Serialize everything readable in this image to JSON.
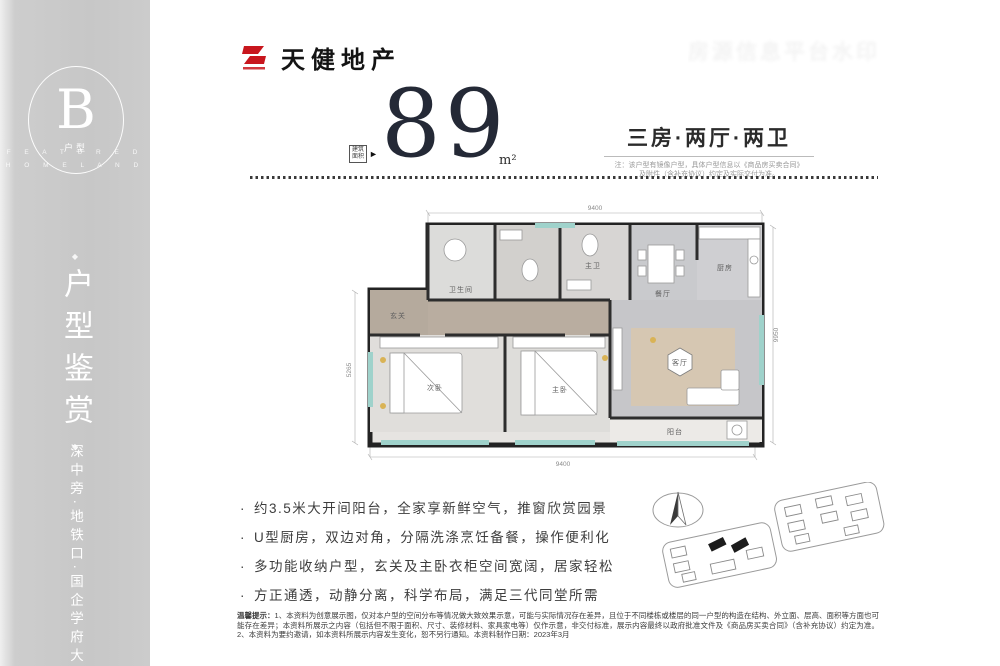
{
  "brand": {
    "name": "天健地产"
  },
  "watermark_text": "房源信息平台水印",
  "sidebar": {
    "badge_letter": "B",
    "badge_sub": "户型",
    "caption_line1": "F E A T U R E D",
    "caption_line2": "H O M E L A N D",
    "ornament": "◆",
    "vertical_title": "户型鉴赏",
    "vertical_slogan": "深中旁·地铁口·国企学府大城"
  },
  "headline": {
    "area_tag_line1": "建筑",
    "area_tag_line2": "面积",
    "area_arrow": "►",
    "area_value": "89",
    "area_unit": "m²",
    "layout_title": "三房·两厅·两卫",
    "note_line1": "注：该户型有镜像户型，具体户型信息以《商品房买卖合同》",
    "note_line2": "及附件（含补充协议）约定及实际交付为准。"
  },
  "floorplan": {
    "dim_top": "9400",
    "dim_bottom": "9400",
    "dim_left": "5265",
    "dim_right": "9950",
    "rooms": {
      "entry": "玄关",
      "bath": "卫生间",
      "master_bath": "主卫",
      "dining": "餐厅",
      "kitchen": "厨房",
      "bedroom2": "次卧",
      "master": "主卧",
      "living": "客厅",
      "balcony": "阳台"
    }
  },
  "features": [
    "约3.5米大开间阳台，全家享新鲜空气，推窗欣赏园景",
    "U型厨房，双边对角，分隔洗涤烹饪备餐，操作便利化",
    "多功能收纳户型，玄关及主卧衣柜空间宽阔，居家轻松",
    "方正通透，动静分离，科学布局，满足三代同堂所需"
  ],
  "disclaimer": {
    "lead": "温馨提示：",
    "body": "1、本资料为创意展示图，仅对本户型的空间分布等情况做大致效果示意，可能与实际情况存在差异，且位于不同楼栋或楼层的同一户型的构造在结构、外立面、层高、面积等方面也可能存在差异；本资料所展示之内容（包括但不限于面积、尺寸、装修材料、家具家电等）仅作示意，非交付标准，展示内容最终以政府批准文件及《商品房买卖合同》（含补充协议）约定为准。2、本资料为要约邀请，如本资料所展示内容发生变化，恕不另行通知。本资料制作日期：2023年3月"
  }
}
